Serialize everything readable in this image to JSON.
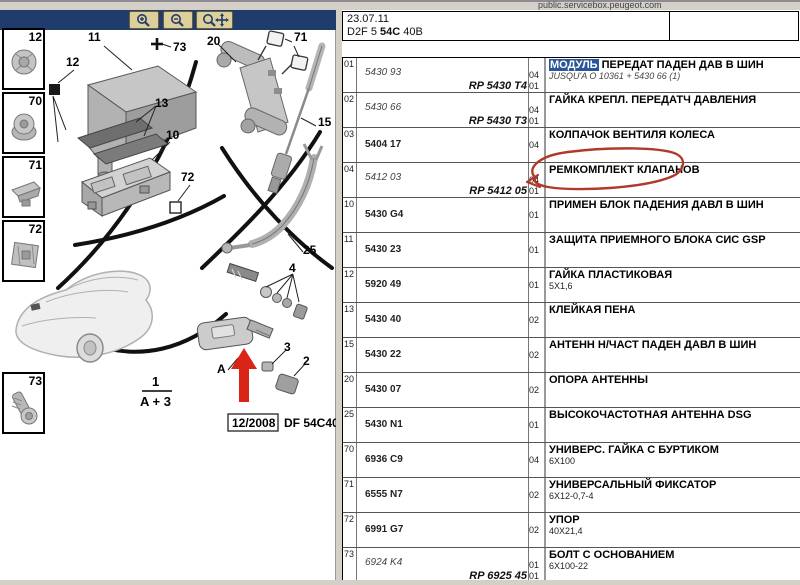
{
  "window": {
    "site": "public.servicebox.peugeot.com"
  },
  "toolbar": {
    "buttons": [
      {
        "name": "zoom-in"
      },
      {
        "name": "zoom-out"
      },
      {
        "name": "zoom-pan"
      }
    ]
  },
  "header": {
    "date": "23.07.11",
    "code_prefix": "D2F 5",
    "code_bold": "54C",
    "code_suffix": "40B"
  },
  "sidebar_thumbs": [
    {
      "label": "12",
      "top": 18
    },
    {
      "label": "70",
      "top": 82
    },
    {
      "label": "71",
      "top": 146
    },
    {
      "label": "72",
      "top": 210
    },
    {
      "label": "73",
      "top": 362
    }
  ],
  "diagram": {
    "callouts": [
      {
        "label": "11",
        "x": 88,
        "y": 21
      },
      {
        "label": "73",
        "x": 173,
        "y": 31
      },
      {
        "label": "12",
        "x": 66,
        "y": 46
      },
      {
        "label": "13",
        "x": 155,
        "y": 87
      },
      {
        "label": "10",
        "x": 166,
        "y": 119
      },
      {
        "label": "72",
        "x": 181,
        "y": 161
      },
      {
        "label": "20",
        "x": 207,
        "y": 25
      },
      {
        "label": "71",
        "x": 294,
        "y": 21
      },
      {
        "label": "15",
        "x": 318,
        "y": 106
      },
      {
        "label": "25",
        "x": 303,
        "y": 234
      },
      {
        "label": "4",
        "x": 289,
        "y": 252
      },
      {
        "label": "3",
        "x": 284,
        "y": 331
      },
      {
        "label": "2",
        "x": 303,
        "y": 345
      },
      {
        "label": "A",
        "x": 217,
        "y": 353
      }
    ],
    "fraction": {
      "num": "1",
      "den": "A + 3"
    },
    "date_box": "12/2008",
    "plate_code": "DF 54C40B"
  },
  "parts_table": {
    "rows": [
      {
        "item": "01",
        "ref": "5430 93",
        "ref_italic": true,
        "rp": "RP 5430 T4",
        "qty": "04",
        "qty2": "01",
        "desc_hl": "МОДУЛЬ",
        "desc": "ПЕРЕДАТ ПАДЕН ДАВ В ШИН",
        "desc_sub": "JUSQU'A O 10361 + 5430 66 (1)",
        "desc_sub_italic": true
      },
      {
        "item": "02",
        "ref": "5430 66",
        "ref_italic": true,
        "rp": "RP 5430 T3",
        "qty": "04",
        "qty2": "01",
        "desc": "ГАЙКА КРЕПЛ. ПЕРЕДАТЧ ДАВЛЕНИЯ"
      },
      {
        "item": "03",
        "ref": "5404 17",
        "qty": "04",
        "desc": "КОЛПАЧОК ВЕНТИЛЯ КОЛЕСА"
      },
      {
        "item": "04",
        "ref": "5412 03",
        "ref_italic": true,
        "rp": "RP 5412 05",
        "qty": "04",
        "qty2": "01",
        "desc": "РЕМКОМПЛЕКТ КЛАПАНОВ"
      },
      {
        "item": "10",
        "ref": "5430 G4",
        "qty": "01",
        "desc": "ПРИМЕН БЛОК ПАДЕНИЯ ДАВЛ В ШИН"
      },
      {
        "item": "11",
        "ref": "5430 23",
        "qty": "01",
        "desc": "ЗАЩИТА ПРИЕМНОГО БЛОКА СИС GSP"
      },
      {
        "item": "12",
        "ref": "5920 49",
        "qty": "01",
        "desc": "ГАЙКА ПЛАСТИКОВАЯ",
        "desc_sub": "5X1,6"
      },
      {
        "item": "13",
        "ref": "5430 40",
        "qty": "02",
        "desc": "КЛЕЙКАЯ ПЕНА"
      },
      {
        "item": "15",
        "ref": "5430 22",
        "qty": "02",
        "desc": "АНТЕНН Н/ЧАСТ ПАДЕН ДАВЛ В ШИН"
      },
      {
        "item": "20",
        "ref": "5430 07",
        "qty": "02",
        "desc": "ОПОРА АНТЕННЫ"
      },
      {
        "item": "25",
        "ref": "5430 N1",
        "qty": "01",
        "desc": "ВЫСОКОЧАСТОТНАЯ АНТЕННА DSG"
      },
      {
        "item": "70",
        "ref": "6936 C9",
        "qty": "04",
        "desc": "УНИВЕРС. ГАЙКА С БУРТИКОМ",
        "desc_sub": "6X100"
      },
      {
        "item": "71",
        "ref": "6555 N7",
        "qty": "02",
        "desc": "УНИВЕРСАЛЬНЫЙ ФИКСАТОР",
        "desc_sub": "6X12-0,7-4"
      },
      {
        "item": "72",
        "ref": "6991 G7",
        "qty": "02",
        "desc": "УПОР",
        "desc_sub": "40X21,4"
      },
      {
        "item": "73",
        "ref": "6924 K4",
        "ref_italic": true,
        "rp": "RP 6925 45",
        "qty": "01",
        "qty2": "01",
        "desc": "БОЛТ С ОСНОВАНИЕМ",
        "desc_sub": "6X100-22"
      }
    ]
  },
  "colors": {
    "navbar": "#1f3c6d",
    "button": "#dccf9a",
    "highlight": "#2a5699",
    "annotation_red": "#b03a2a",
    "arrow_red": "#da2418"
  }
}
